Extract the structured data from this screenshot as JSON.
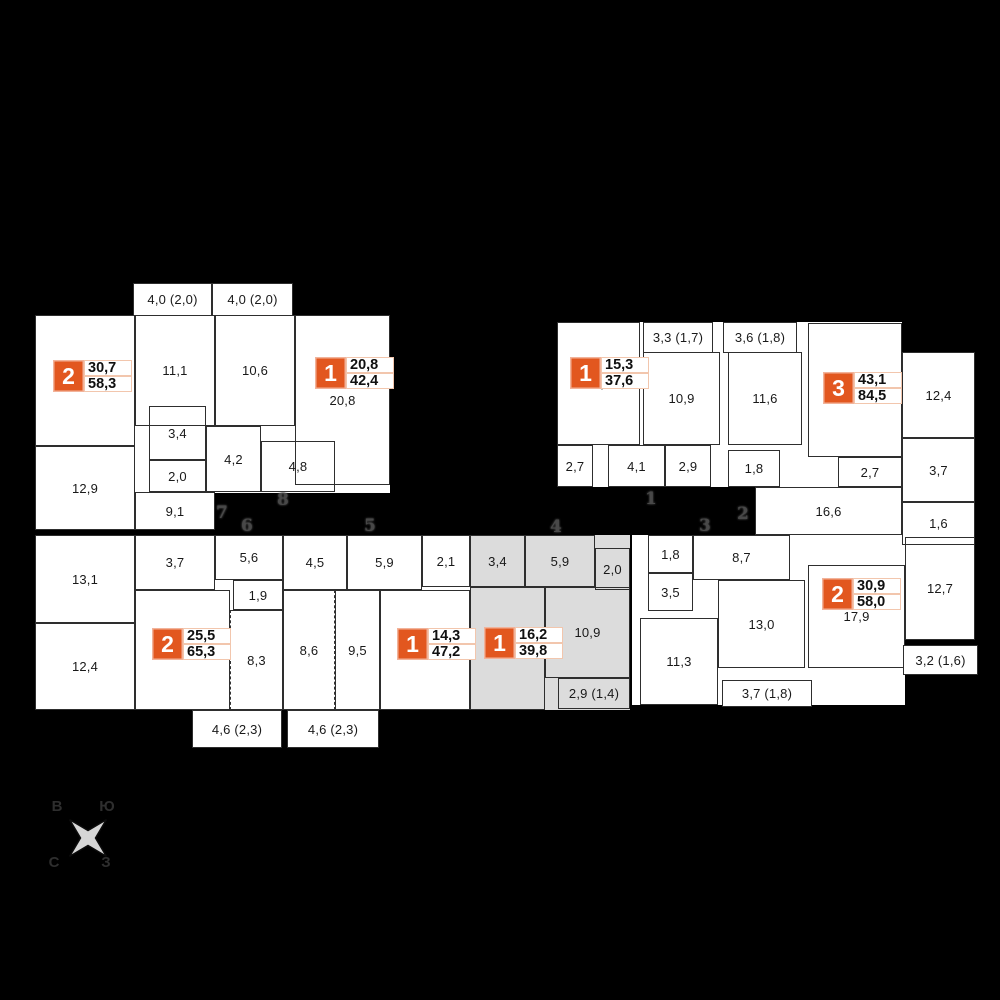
{
  "colors": {
    "background": "#000000",
    "accent": "#e2571f",
    "badge_value_border": "#f2c6ad",
    "highlight": "#dcdcdc",
    "wall": "#2e2e2e",
    "corridor_number": "#484848"
  },
  "compass": {
    "top_left": "В",
    "top_right": "Ю",
    "bottom_left": "С",
    "bottom_right": "З"
  },
  "blocks": [
    {
      "x": 35,
      "y": 315,
      "w": 355,
      "h": 178
    },
    {
      "x": 35,
      "y": 446,
      "w": 180,
      "h": 84
    },
    {
      "x": 557,
      "y": 322,
      "w": 345,
      "h": 165
    },
    {
      "x": 755,
      "y": 487,
      "w": 147,
      "h": 48
    },
    {
      "x": 902,
      "y": 352,
      "w": 73,
      "h": 193
    },
    {
      "x": 35,
      "y": 535,
      "w": 595,
      "h": 175
    },
    {
      "x": 632,
      "y": 535,
      "w": 273,
      "h": 170
    },
    {
      "x": 905,
      "y": 537,
      "w": 70,
      "h": 103
    },
    {
      "x": 470,
      "y": 535,
      "w": 160,
      "h": 175,
      "gray": true
    }
  ],
  "rooms": [
    {
      "label": "17,8",
      "x": 35,
      "y": 315,
      "w": 100,
      "h": 131
    },
    {
      "label": "12,9",
      "x": 35,
      "y": 446,
      "w": 100,
      "h": 84
    },
    {
      "label": "11,1",
      "x": 135,
      "y": 315,
      "w": 80,
      "h": 111
    },
    {
      "label": "3,4",
      "x": 149,
      "y": 406,
      "w": 57,
      "h": 54
    },
    {
      "label": "2,0",
      "x": 149,
      "y": 460,
      "w": 57,
      "h": 32
    },
    {
      "label": "9,1",
      "x": 135,
      "y": 492,
      "w": 80,
      "h": 38
    },
    {
      "label": "4,2",
      "x": 206,
      "y": 426,
      "w": 55,
      "h": 66
    },
    {
      "label": "10,6",
      "x": 215,
      "y": 315,
      "w": 80,
      "h": 111
    },
    {
      "label": "20,8",
      "x": 295,
      "y": 315,
      "w": 95,
      "h": 170
    },
    {
      "label": "4,8",
      "x": 261,
      "y": 441,
      "w": 74,
      "h": 51
    },
    {
      "label": "15,3",
      "x": 557,
      "y": 322,
      "w": 83,
      "h": 123
    },
    {
      "label": "10,9",
      "x": 643,
      "y": 352,
      "w": 77,
      "h": 93
    },
    {
      "label": "2,7",
      "x": 557,
      "y": 445,
      "w": 36,
      "h": 42
    },
    {
      "label": "4,1",
      "x": 608,
      "y": 445,
      "w": 57,
      "h": 42
    },
    {
      "label": "2,9",
      "x": 665,
      "y": 445,
      "w": 46,
      "h": 42
    },
    {
      "label": "11,6",
      "x": 728,
      "y": 352,
      "w": 74,
      "h": 93
    },
    {
      "label": "1,8",
      "x": 728,
      "y": 450,
      "w": 52,
      "h": 37
    },
    {
      "label": "18,0",
      "x": 808,
      "y": 323,
      "w": 94,
      "h": 134
    },
    {
      "label": "2,7",
      "x": 838,
      "y": 457,
      "w": 64,
      "h": 30
    },
    {
      "label": "16,6",
      "x": 755,
      "y": 487,
      "w": 147,
      "h": 48
    },
    {
      "label": "12,4",
      "x": 902,
      "y": 352,
      "w": 73,
      "h": 86
    },
    {
      "label": "3,7",
      "x": 902,
      "y": 438,
      "w": 73,
      "h": 64
    },
    {
      "label": "1,6",
      "x": 902,
      "y": 502,
      "w": 73,
      "h": 43
    },
    {
      "label": "13,1",
      "x": 35,
      "y": 535,
      "w": 100,
      "h": 88
    },
    {
      "label": "12,4",
      "x": 35,
      "y": 623,
      "w": 100,
      "h": 87
    },
    {
      "label": "3,7",
      "x": 135,
      "y": 535,
      "w": 80,
      "h": 55
    },
    {
      "label": "5,6",
      "x": 215,
      "y": 535,
      "w": 68,
      "h": 45
    },
    {
      "label": "1,9",
      "x": 233,
      "y": 580,
      "w": 50,
      "h": 30
    },
    {
      "label": "18,0",
      "x": 135,
      "y": 590,
      "w": 95,
      "h": 120
    },
    {
      "label": "8,3",
      "x": 230,
      "y": 610,
      "w": 53,
      "h": 100,
      "dashLeft": true
    },
    {
      "label": "4,5",
      "x": 283,
      "y": 535,
      "w": 64,
      "h": 55
    },
    {
      "label": "5,9",
      "x": 347,
      "y": 535,
      "w": 75,
      "h": 55
    },
    {
      "label": "2,1",
      "x": 422,
      "y": 535,
      "w": 48,
      "h": 52
    },
    {
      "label": "8,6",
      "x": 283,
      "y": 590,
      "w": 52,
      "h": 120,
      "dashRight": true
    },
    {
      "label": "9,5",
      "x": 335,
      "y": 590,
      "w": 45,
      "h": 120
    },
    {
      "label": "14,3",
      "x": 380,
      "y": 590,
      "w": 90,
      "h": 120
    },
    {
      "label": "3,4",
      "x": 470,
      "y": 535,
      "w": 55,
      "h": 52
    },
    {
      "label": "5,9",
      "x": 525,
      "y": 535,
      "w": 70,
      "h": 52
    },
    {
      "label": "2,0",
      "x": 595,
      "y": 548,
      "w": 35,
      "h": 42
    },
    {
      "label": "10,9",
      "x": 545,
      "y": 587,
      "w": 85,
      "h": 91
    },
    {
      "label": "16,2",
      "x": 470,
      "y": 587,
      "w": 75,
      "h": 123
    },
    {
      "label": "1,8",
      "x": 648,
      "y": 535,
      "w": 45,
      "h": 38
    },
    {
      "label": "8,7",
      "x": 693,
      "y": 535,
      "w": 97,
      "h": 45
    },
    {
      "label": "3,5",
      "x": 648,
      "y": 573,
      "w": 45,
      "h": 38
    },
    {
      "label": "13,0",
      "x": 718,
      "y": 580,
      "w": 87,
      "h": 88
    },
    {
      "label": "11,3",
      "x": 640,
      "y": 618,
      "w": 78,
      "h": 87
    },
    {
      "label": "17,9",
      "x": 808,
      "y": 565,
      "w": 97,
      "h": 103
    },
    {
      "label": "12,7",
      "x": 905,
      "y": 537,
      "w": 70,
      "h": 103
    }
  ],
  "balconies": [
    {
      "label": "4,0 (2,0)",
      "x": 133,
      "y": 283,
      "w": 79,
      "h": 33
    },
    {
      "label": "4,0 (2,0)",
      "x": 212,
      "y": 283,
      "w": 81,
      "h": 33
    },
    {
      "label": "3,3 (1,7)",
      "x": 643,
      "y": 322,
      "w": 70,
      "h": 31
    },
    {
      "label": "3,6 (1,8)",
      "x": 723,
      "y": 322,
      "w": 74,
      "h": 31
    },
    {
      "label": "4,6 (2,3)",
      "x": 192,
      "y": 710,
      "w": 90,
      "h": 38
    },
    {
      "label": "4,6 (2,3)",
      "x": 287,
      "y": 710,
      "w": 92,
      "h": 38
    },
    {
      "label": "2,9 (1,4)",
      "x": 558,
      "y": 678,
      "w": 72,
      "h": 31,
      "gray": true
    },
    {
      "label": "3,7 (1,8)",
      "x": 722,
      "y": 680,
      "w": 90,
      "h": 27
    },
    {
      "label": "3,2 (1,6)",
      "x": 903,
      "y": 645,
      "w": 75,
      "h": 30
    }
  ],
  "apartments": [
    {
      "rooms_count": "2",
      "living_area": "30,7",
      "total_area": "58,3",
      "x": 53,
      "y": 360
    },
    {
      "rooms_count": "1",
      "living_area": "20,8",
      "total_area": "42,4",
      "x": 315,
      "y": 357
    },
    {
      "rooms_count": "1",
      "living_area": "15,3",
      "total_area": "37,6",
      "x": 570,
      "y": 357
    },
    {
      "rooms_count": "3",
      "living_area": "43,1",
      "total_area": "84,5",
      "x": 823,
      "y": 372
    },
    {
      "rooms_count": "2",
      "living_area": "25,5",
      "total_area": "65,3",
      "x": 152,
      "y": 628
    },
    {
      "rooms_count": "1",
      "living_area": "14,3",
      "total_area": "47,2",
      "x": 397,
      "y": 628
    },
    {
      "rooms_count": "1",
      "living_area": "16,2",
      "total_area": "39,8",
      "x": 484,
      "y": 627,
      "highlighted": true
    },
    {
      "rooms_count": "2",
      "living_area": "30,9",
      "total_area": "58,0",
      "x": 822,
      "y": 578
    }
  ],
  "corridor_numbers": [
    {
      "label": "7",
      "x": 216,
      "y": 503
    },
    {
      "label": "8",
      "x": 277,
      "y": 490
    },
    {
      "label": "6",
      "x": 241,
      "y": 516
    },
    {
      "label": "5",
      "x": 364,
      "y": 516
    },
    {
      "label": "4",
      "x": 550,
      "y": 517
    },
    {
      "label": "1",
      "x": 645,
      "y": 489
    },
    {
      "label": "2",
      "x": 737,
      "y": 504
    },
    {
      "label": "3",
      "x": 699,
      "y": 516
    }
  ]
}
